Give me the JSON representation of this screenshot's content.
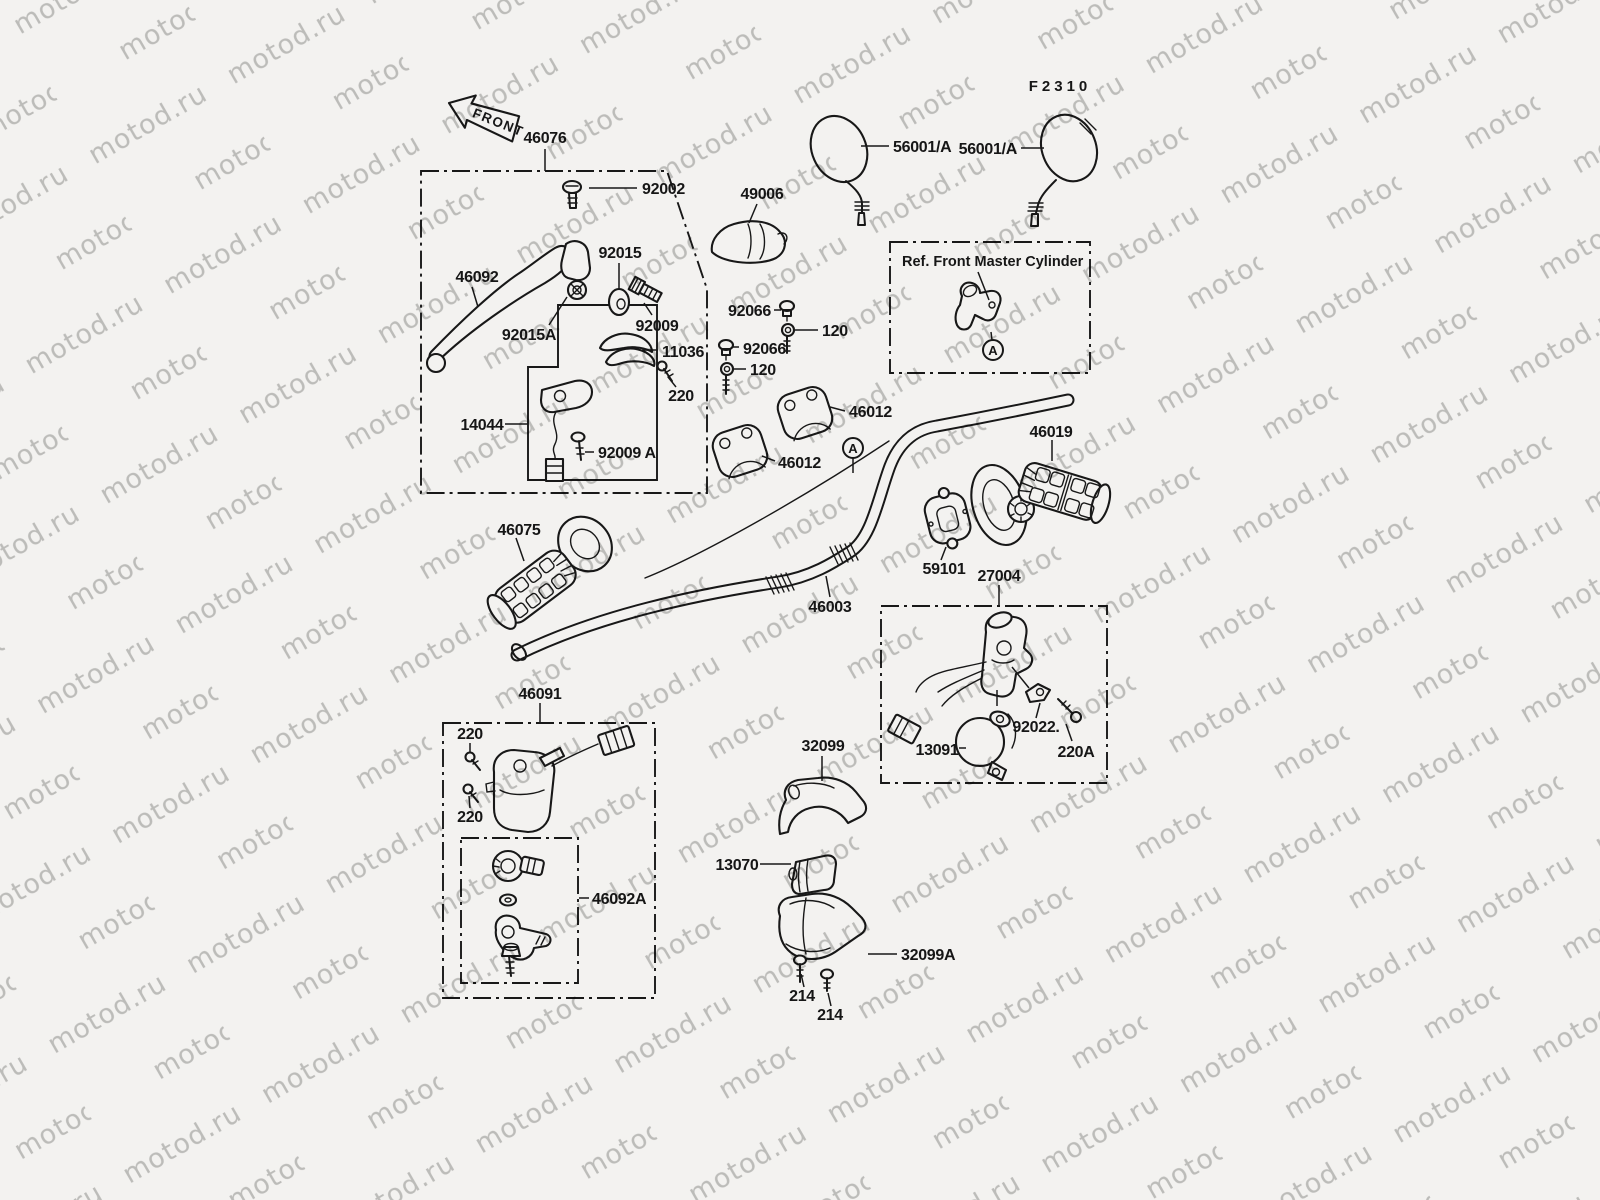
{
  "sheet": {
    "code": "F2310",
    "watermark": "motod.ru",
    "front_arrow": "FRONT",
    "ref_box_title": "Ref. Front Master Cylinder",
    "detail_marker": "A"
  },
  "parts": {
    "46076": "46076",
    "92002": "92002",
    "49006": "49006",
    "92015": "92015",
    "46092": "46092",
    "92015A": "92015A",
    "92009": "92009",
    "11036": "11036",
    "220": "220",
    "14044": "14044",
    "92009A": "92009 A",
    "92066": "92066",
    "120": "120",
    "46012": "46012",
    "56001A": "56001/A",
    "46019": "46019",
    "46075": "46075",
    "59101": "59101",
    "27004": "27004",
    "46003": "46003",
    "46091": "46091",
    "46092A": "46092A",
    "32099": "32099",
    "13070": "13070",
    "32099A": "32099A",
    "214": "214",
    "92022": "92022.",
    "13091": "13091",
    "220A": "220A"
  },
  "colors": {
    "paper": "#f3f2f0",
    "ink": "#181818",
    "watermark": "#c6c6c5"
  }
}
